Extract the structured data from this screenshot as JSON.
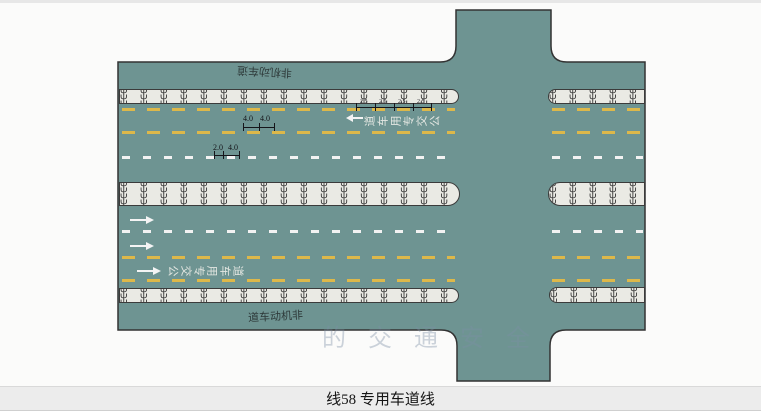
{
  "caption": "线58 专用车道线",
  "figure": {
    "type": "road-marking-plan",
    "labels": {
      "top_nonmotor_lane": "非机动车道",
      "bottom_nonmotor_lane": "非机动车道",
      "top_bus_lane_text": "公交专用车道",
      "bottom_bus_lane_text": "公交专用车道"
    },
    "dimensions": {
      "yellow_dash_values": [
        "4.0",
        "4.0"
      ],
      "white_dash_values": [
        "2.0",
        "4.0"
      ],
      "char_spacing_values": [
        "2.5",
        "2.5",
        "2.5",
        "2.5"
      ]
    },
    "arrows": {
      "bottom_half_direction": "right",
      "bottom_half_count": 3,
      "top_half_direction": "left",
      "top_half_count": 1
    },
    "grass_symbol": "Ψ",
    "watermark": "的交通安全",
    "colors": {
      "road_surface": "#6e9492",
      "road_outline": "#333333",
      "median_fill": "#eaeae4",
      "yellow_line": "#ddb84a",
      "white_line": "#f2f2f2",
      "caption_bg": "#ececec"
    }
  }
}
